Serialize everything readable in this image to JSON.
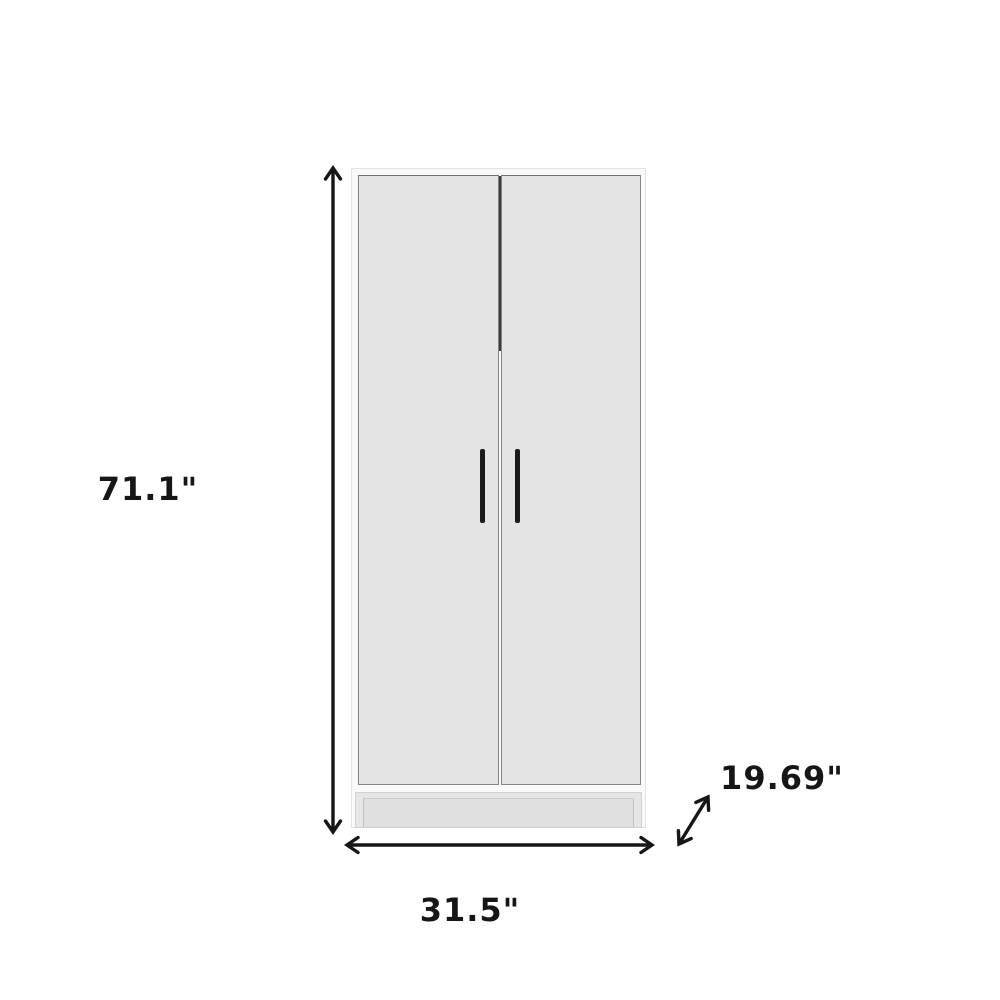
{
  "page": {
    "background_color": "#ffffff"
  },
  "diagram": {
    "subject": "two-door-wardrobe-cabinet",
    "style": "dimension-annotated-product-drawing",
    "dimensions": {
      "height": {
        "label": "71.1\"",
        "axis": "vertical"
      },
      "width": {
        "label": "31.5\"",
        "axis": "horizontal"
      },
      "depth": {
        "label": "19.69\"",
        "axis": "diagonal"
      }
    },
    "colors": {
      "annotation": "#161616",
      "frame_fill": "#fafafa",
      "frame_border": "#e4e4e4",
      "door_fill": "#e4e4e4",
      "door_border": "#848484",
      "seam_dark": "#3a3a3a",
      "handle": "#1b1b1b",
      "base_fill": "#e6e6e6"
    }
  }
}
